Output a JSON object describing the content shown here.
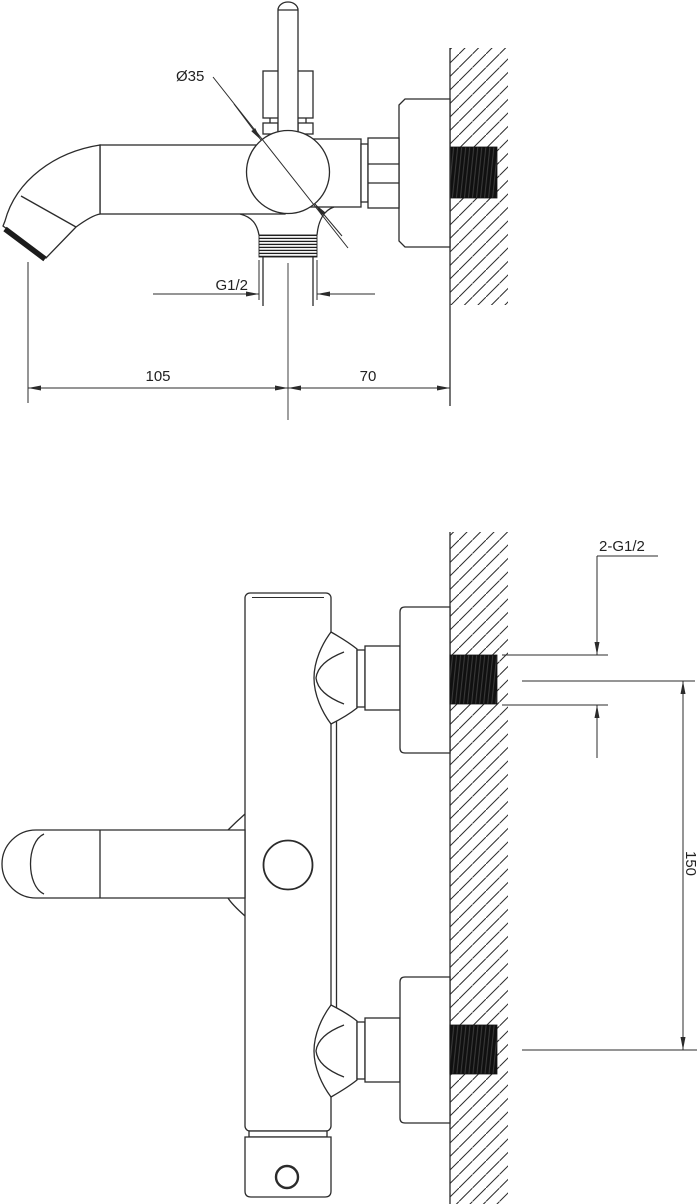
{
  "page": {
    "background": "#ffffff"
  },
  "drawing": {
    "kind": "technical-installation-drawing",
    "subject": "wall-mounted bath shower mixer tap, two dimensioned views",
    "line_color": "#2b2b2b",
    "thread_fill_color": "#101010",
    "labels": {
      "spout_diameter": "Ø35",
      "outlet_thread": "G1/2",
      "spout_reach": "105",
      "wall_offset": "70",
      "inlet_thread": "2-G1/2",
      "inlet_spacing": "150"
    }
  }
}
